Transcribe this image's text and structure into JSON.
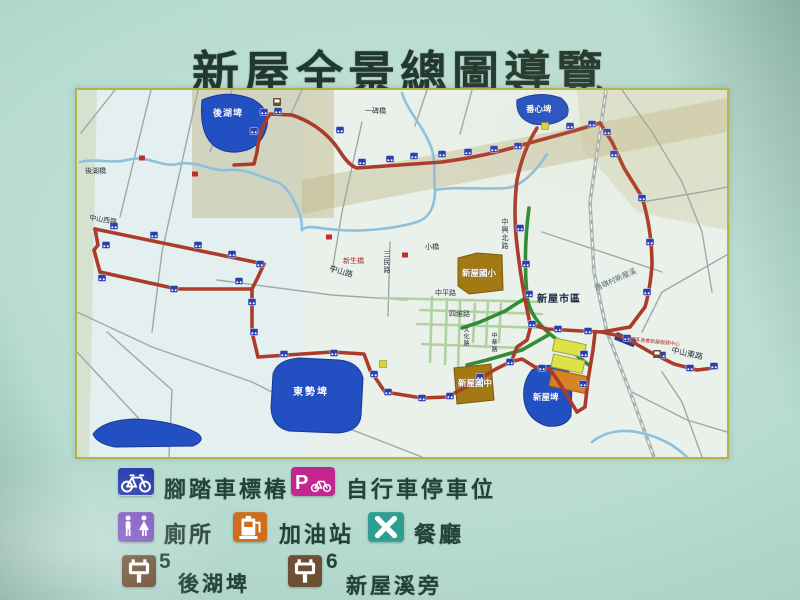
{
  "title": "新屋全景總圖導覽",
  "legend": {
    "items": [
      {
        "id": "bike-post",
        "label": "腳踏車標樁"
      },
      {
        "id": "bike-parking",
        "label": "自行車停車位"
      },
      {
        "id": "toilet",
        "label": "廁所"
      },
      {
        "id": "gas-station",
        "label": "加油站"
      },
      {
        "id": "restaurant",
        "label": "餐廳"
      },
      {
        "id": "stop-5",
        "number": "5",
        "label": "後湖埤"
      },
      {
        "id": "stop-6",
        "number": "6",
        "label": "新屋溪旁"
      }
    ]
  },
  "map": {
    "labels": {
      "houhu_pond": "後湖埤",
      "fanxin_pond": "番心埤",
      "dongshi_pond": "東勢埤",
      "xinwu_pond": "新屋埤",
      "houhu_bridge": "後湖橋",
      "yibei_bridge": "一碑橋",
      "small_bridge": "小橋",
      "xinsheng_bridge": "新生橋",
      "zhongshan_w_rd": "中山西路",
      "zhongshan_rd": "中山路",
      "sanmin_rd": "三民路",
      "zhongxing_n_rd": "中興北路",
      "zhongping_rd": "中平路",
      "siwei_rd": "四維路",
      "wenhua_rd": "文化路",
      "zhonghua_rd": "中華路",
      "downtown": "新屋市區",
      "creek": "過嶺村新屋溪",
      "zhongshan_e_rd": "中山東路",
      "elementary": "新屋國小",
      "junior_high": "新屋國中",
      "service_center": "中壢區漁會新屋服務中心"
    }
  },
  "colors": {
    "route_red": "#b03a28",
    "pond_blue": "#2050c8",
    "marker_blue": "#2a3fae",
    "parking_magenta": "#c4258f",
    "toilet_purple": "#7b52c1",
    "gas_orange": "#cd6d1d",
    "restaurant_teal": "#2e9e92",
    "sign_brown": "#6d4f33",
    "board_green": "#b9ddd2"
  }
}
